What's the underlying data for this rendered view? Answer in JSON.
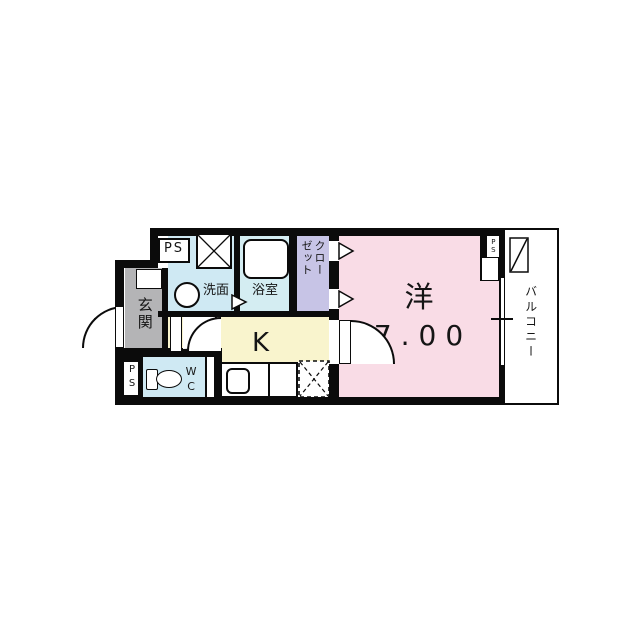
{
  "floor_plan": {
    "labels": {
      "entrance": "玄関",
      "washroom": "洗面",
      "bathroom": "浴室",
      "closet": "クローゼット",
      "kitchen": "K",
      "western_room": "洋",
      "western_room_size": "7.00",
      "toilet": "WC",
      "balcony": "バルコニー",
      "pipe_space_top_left": "PS",
      "pipe_space_bottom_left": "PS",
      "pipe_space_room": "PS"
    },
    "colors": {
      "wall": "#0b0b0b",
      "entrance_floor": "#b4b4b6",
      "wet_area_floor": "#cfe9f3",
      "bathroom_floor": "#d4edf2",
      "closet_floor": "#c7c4e6",
      "kitchen_floor": "#f9f4cd",
      "western_room_floor": "#f9dce6",
      "balcony_floor": "#ffffff"
    },
    "fixtures": [
      "bathtub",
      "wash-basin",
      "toilet",
      "kitchen-sink",
      "washing-machine-space",
      "refrigerator-space",
      "balcony-partition",
      "shoe-cabinet",
      "entrance-door-swing",
      "room-door-swing",
      "hall-door-swings",
      "closet-folding-door-markers",
      "bathroom-door-marker",
      "window-right-wall"
    ]
  }
}
